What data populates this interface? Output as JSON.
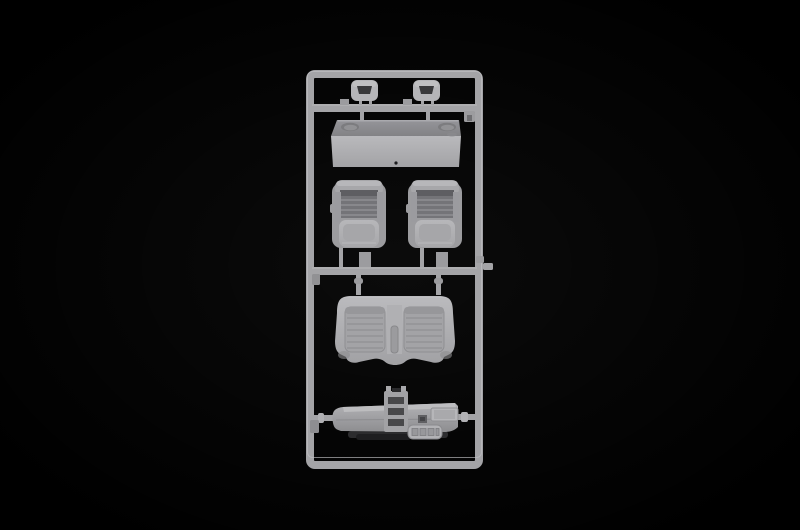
{
  "scene": {
    "type": "photograph",
    "subject": "Injection-molded light gray plastic model kit sprue (parts runner) with car interior parts, photographed on a black background",
    "background_color": "#000000",
    "colors": {
      "rail": "#a4a4a7",
      "rail_highlight": "#c2c2c4",
      "rail_shadow": "#717174",
      "part_light": "#b5b5b8",
      "part_mid": "#9c9c9f",
      "part_dark": "#747478",
      "rib_dark": "#5e5e62",
      "recess": "#a3a3a6",
      "hole_dark": "#48484a",
      "shadow_under": "#2c2c2e",
      "box_top": "#8c8c8f",
      "bg": "#000000"
    },
    "parts": [
      {
        "id": "runner-frame",
        "label": "Rectangular sprue runner frame with cross bars"
      },
      {
        "id": "headrest-left",
        "label": "Seat headrest with open center (left)"
      },
      {
        "id": "headrest-right",
        "label": "Seat headrest with open center (right)"
      },
      {
        "id": "shelf-box",
        "label": "Rectangular box part with two round recesses (parcel shelf)"
      },
      {
        "id": "bucket-seat-left",
        "label": "Front bucket seat with ribbed backrest (left)"
      },
      {
        "id": "bucket-seat-right",
        "label": "Front bucket seat with ribbed backrest (right)"
      },
      {
        "id": "bench-seat",
        "label": "Rear bench seat with two ribbed seat panels"
      },
      {
        "id": "dashboard-assembly",
        "label": "Dashboard / console assembly with ladder bracket and button panel"
      }
    ]
  }
}
